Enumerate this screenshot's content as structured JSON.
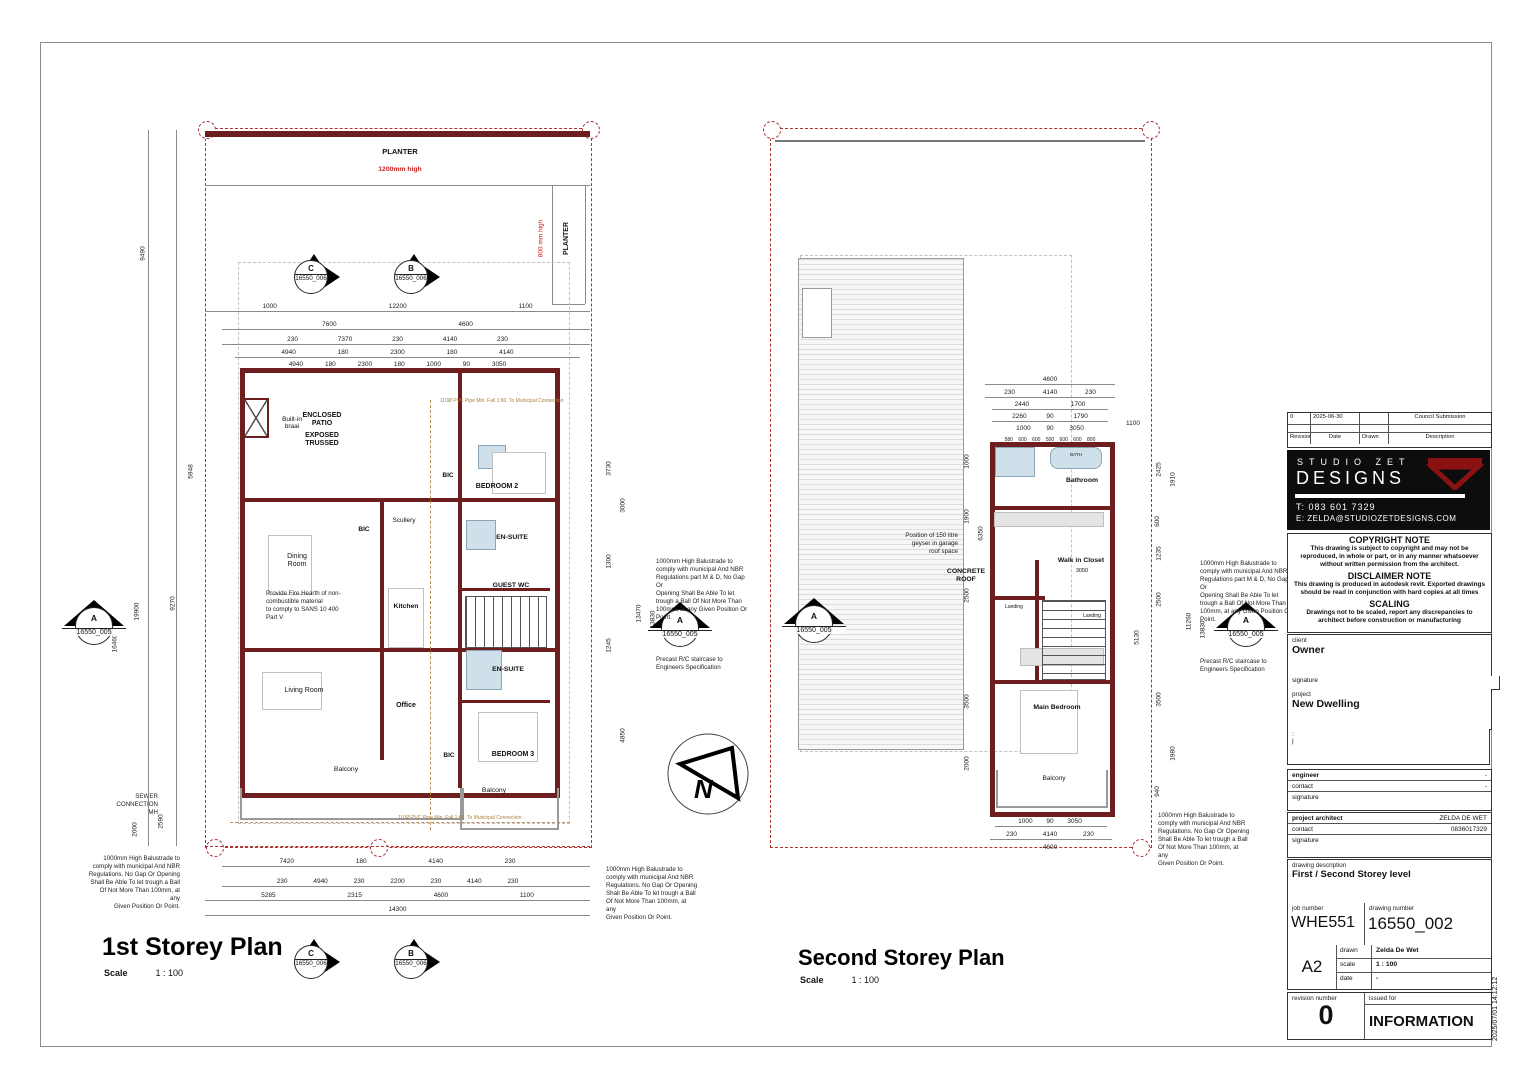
{
  "plan1": {
    "title": "1st Storey Plan",
    "scale_label": "Scale",
    "scale_value": "1 : 100",
    "planter_label": "PLANTER",
    "planter_height": "1200mm high",
    "planter_side_label": "PLANTER",
    "planter_side_height": "800 mm high",
    "rooms": {
      "braai": "Built-in\nbraai",
      "patio1": "ENCLOSED\nPATIO",
      "patio2": "EXPOSED\nTRUSSED",
      "bedroom2": "BEDROOM 2",
      "bic_bed2": "BIC",
      "scullery": "Scullery",
      "bic_kitchen": "BIC",
      "ensuite1": "EN-SUITE",
      "guest_wc": "GUEST WC",
      "dining": "Dining\nRoom",
      "kitchen": "Kitchen",
      "living": "Living Room",
      "office": "Office",
      "ensuite2": "EN-SUITE",
      "bedroom3": "BEDROOM 3",
      "bic_bed3": "BIC",
      "balcony_left": "Balcony",
      "balcony_right": "Balcony"
    },
    "notes": {
      "fire_hearth": "Provide Fire Hearth of non-\ncombustible material\nto comply to SANS 10 400\nPart V",
      "sewer": "SEWER\nCONNECTION\nMH",
      "balustrade": "1000mm High Balustrade to\ncomply with municipal And NBR\nRegulations. No Gap Or Opening\nShall Be Able To let trough a Ball\nOf Not More Than 100mm, at any\nGiven Position Or Point.",
      "balustrade_md": "1000mm High Balustrade to\ncomply with municipal And NBR\nRegulations part M & D, No Gap Or\nOpening Shall Be Able To let\ntrough a Ball Of Not More Than\n100mm, at any Given Position Or\nPoint.",
      "precast": "Precast R/C staircase to\nEngineers Specification",
      "pvc_pipe": "110Ø PVC Pipe Min. Fall 1:60. To Municipal Connection"
    },
    "dims_top": [
      "1000 12200 1100",
      "7600 4600",
      "230 7370 230 4140 230",
      "4940 180 2300 180 4140",
      "4940 180 2300 180 1000 90 3050"
    ],
    "dims_bottom": [
      "7420 180 4140 230",
      "230 4940 230 2200 230 4140 230",
      "5285 2315 4600 1100",
      "14300"
    ],
    "dims_left": [
      "9490",
      "5948",
      "16460",
      "19900",
      "9270",
      "2000",
      "2590"
    ],
    "dims_right": [
      "3730",
      "3000",
      "1300",
      "1245",
      "4850",
      "13470",
      "13830"
    ]
  },
  "plan2": {
    "title": "Second Storey Plan",
    "scale_label": "Scale",
    "scale_value": "1 : 100",
    "roof_label": "CONCRETE\nROOF",
    "geyser_note": "Position of 150 litre\ngeyser in garage\nroof space",
    "rooms": {
      "bathroom": "Bathroom",
      "bath_fixture": "BATH",
      "wic": "Walk in Closet",
      "wic_dim": "3050",
      "landing1": "Landing",
      "landing2": "Landing",
      "main_bedroom": "Main Bedroom",
      "balcony": "Balcony"
    },
    "notes": {
      "balustrade_md": "1000mm High Balustrade to\ncomply with municipal And NBR\nRegulations part M & D, No Gap Or\nOpening Shall Be Able To let\ntrough a Ball Of Not More Than\n100mm, at any Given Position Or\nPoint.",
      "precast": "Precast R/C staircase to\nEngineers Specification",
      "balustrade": "1000mm High Balustrade to\ncomply with municipal And NBR\nRegulations. No Gap Or Opening\nShall Be Able To let trough a Ball\nOf Not More Than 100mm, at any\nGiven Position Or Point."
    },
    "dims_top": [
      "4600",
      "230 4140 230",
      "2440 1700",
      "2260 90 1790",
      "1000 90 3050",
      "580 600 600 500 600 600 800"
    ],
    "dims_top_right": "1100",
    "dims_bottom": [
      "1000 90 3050",
      "230 4140 230",
      "4600"
    ],
    "dims_left": [
      "1000",
      "1900",
      "6350",
      "2500",
      "3500",
      "2000"
    ],
    "dims_right": [
      "2425",
      "1910",
      "600",
      "1235",
      "2500",
      "5130",
      "3500",
      "1980",
      "940",
      "11260",
      "13830"
    ]
  },
  "markers": {
    "a": "A",
    "b": "B",
    "c": "C",
    "ref_a": "16550_005",
    "ref_bc": "16550_006"
  },
  "north_label": "N",
  "title_block": {
    "revision_table": {
      "row": {
        "rev": "0",
        "date": "2025-06-30",
        "drawn": "",
        "desc": "Council Submission"
      },
      "headers": {
        "rev": "Revision",
        "date": "Date",
        "drawn": "Drawn",
        "desc": "Description"
      }
    },
    "logo": {
      "line1": "STUDIO ZET",
      "line2": "DESIGNS",
      "tel": "T: 083 601 7329",
      "email": "E: ZELDA@STUDIOZETDESIGNS.COM",
      "accent": "#8b1212"
    },
    "copyright_head": "COPYRIGHT NOTE",
    "copyright_body": "This drawing is subject to copyright and may not be reproduced, in whole or part, or in any manner whatsoever without written permission from the architect.",
    "disclaimer_head": "DISCLAIMER NOTE",
    "disclaimer_body": "This drawing is produced in autodesk revit. Exported drawings should be read in conjunction with hard copies at all times",
    "scaling_head": "SCALING",
    "scaling_body": "Drawings not to be scaled, report any discrepancies to architect before construction or manufacturing",
    "client_label": "client",
    "client_value": "Owner",
    "signature_label": "signature",
    "project_label": "project",
    "project_value": "New Dwelling",
    "address_line1": ":",
    "address_line2": "|",
    "engineer_label": "engineer",
    "engineer_value": "-",
    "contact_label": "contact",
    "engineer_contact": "-",
    "architect_label": "project architect",
    "architect_value": "ZELDA DE WET",
    "architect_contact": "0836017329",
    "desc_label": "drawing description",
    "desc_value": "First / Second Storey level",
    "job_label": "job number",
    "job_value": "WHE551",
    "dwg_label": "drawing number",
    "dwg_value": "16550_002",
    "sheet_size": "A2",
    "drawn_label": "drawn",
    "drawn_value": "Zelda De Wet",
    "scale_label": "scale",
    "scale_value": "1 : 100",
    "date_label": "date",
    "date_value": "-",
    "rev_num_label": "revision number",
    "rev_num_value": "0",
    "issued_label": "issued for",
    "issued_value": "INFORMATION",
    "timestamp": "2025/07/01 14:12:12"
  }
}
